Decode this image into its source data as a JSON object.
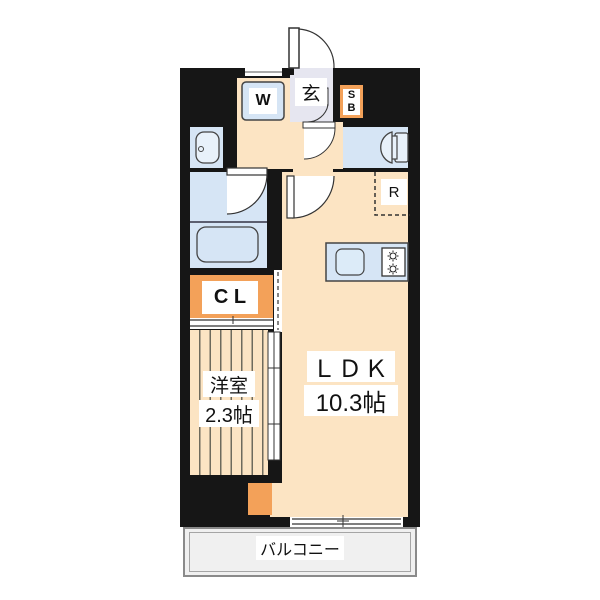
{
  "rooms": {
    "entrance": {
      "label": "玄"
    },
    "washer": {
      "label": "W"
    },
    "shoe_box": {
      "line1": "S",
      "line2": "B"
    },
    "refrigerator": {
      "label": "R"
    },
    "closet": {
      "label": "C L"
    },
    "western_room": {
      "name": "洋室",
      "size": "2.3帖"
    },
    "ldk": {
      "name": "ＬＤＫ",
      "size": "10.3帖"
    },
    "balcony": {
      "label": "バルコニー"
    }
  },
  "colors": {
    "wall": "#161616",
    "floor_cream": "#fce4c3",
    "water_blue": "#d6e5f5",
    "accent_orange": "#f3a159",
    "entrance_floor": "#e6e6f0",
    "balcony_fill": "#f0f0f0",
    "stripe_line": "#6e6a5c"
  }
}
